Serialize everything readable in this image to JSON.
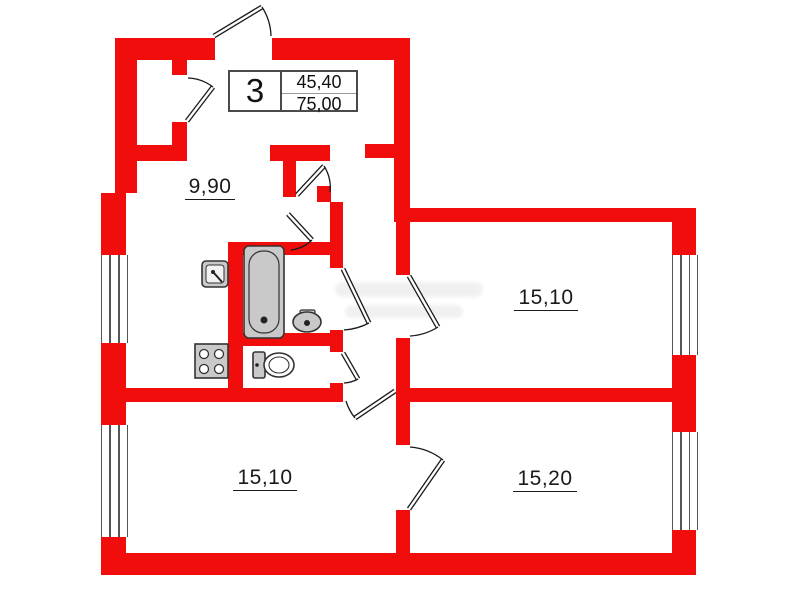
{
  "title_block": {
    "rooms_count": "3",
    "living_area": "45,40",
    "total_area": "75,00"
  },
  "rooms": {
    "kitchen": {
      "area": "9,90"
    },
    "room_right": {
      "area": "15,10"
    },
    "room_bottom_left": {
      "area": "15,10"
    },
    "room_bottom_right": {
      "area": "15,20"
    }
  },
  "fixtures": [
    "bathtub",
    "kitchen-sink",
    "washbasin",
    "toilet",
    "stove"
  ],
  "doors": [
    "entrance",
    "storage",
    "hall-inner-upper",
    "hall-inner-lower",
    "bathroom",
    "wc",
    "room-right",
    "room-bottom-left",
    "room-bottom-right"
  ],
  "windows": [
    "left-upper",
    "left-lower",
    "right-upper",
    "right-lower"
  ],
  "colors": {
    "wall": "#f20d0d",
    "fixture_fill": "#c9c9c9",
    "line": "#333333",
    "label": "#1a1a1a"
  }
}
